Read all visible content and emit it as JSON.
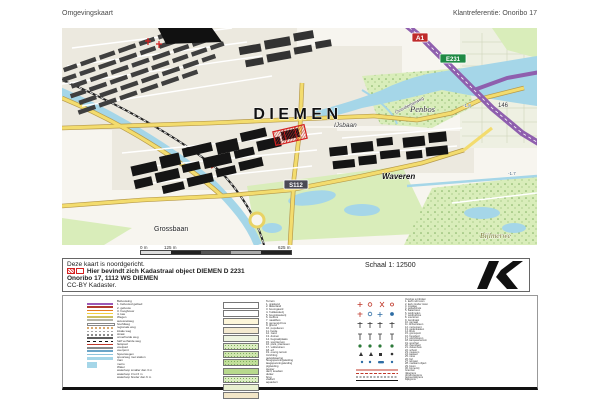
{
  "header": {
    "title": "Omgevingskaart",
    "client_reference": "Klantreferentie: Onoribo 17"
  },
  "map": {
    "labels": {
      "city": "DIEMEN",
      "ijsbaan": "IJsbaan",
      "penbos": "Penbos",
      "overdiemerweg": "Overdiemerweg",
      "waveren": "Waveren",
      "grossbaan": "Grossbaan",
      "bijlmerweide": "Bijlmerwe",
      "height_146": "146",
      "depth_18": "-1.8",
      "depth_17": "-1.7"
    },
    "shields": {
      "a1": "A1",
      "e231": "E231",
      "s112": "S112"
    },
    "colors": {
      "water": "#a5d6e8",
      "grass": "#d9edba",
      "field": "#eef0e2",
      "motorway": "#8f5fae",
      "main_road": "#f3dc6e",
      "building": "#151515",
      "residential_building": "#3f3f3f",
      "parcel_red": "#d42020",
      "urban_bg": "#f7f5ef"
    }
  },
  "scalebar": {
    "label_0": "0 m",
    "label_125": "125 m",
    "label_625": "625 m"
  },
  "infobox": {
    "line1": "Deze kaart is noordgericht.",
    "line2": "Hier bevindt zich Kadastraal object DIEMEN D 2231",
    "line3": "Onoribo 17, 1112 WS DIEMEN",
    "line4": "CC-BY Kadaster.",
    "scale": "Schaal 1: 12500"
  },
  "legend": {
    "colA_text": "Bebouwing\n1. bebouwd gebied\n2. gebouw\n3. hoogbouw\n4. kas\nWegen\nautosnelweg\nhoofdweg\nregionale weg\nlokale weg\nstraat\nonverharde weg\nhalf verharde weg\nfietspad\nvoetpad\nveerpont\nSpoorwegen\nspoorweg met station\ntram\nmetro\nWater\nwaterloop smaller dan 3 m\nwaterloop 3 tot 6 m\nwaterloop breder dan 6 m",
    "colC_text": "Terrein\n1. grasland\n2. akkerland\n3. boomgaard\n4. fruitkwekerij\n5. boomkwekerij\n6. loofbos\n7. naaldbos\n8. gemengd bos\n9. griend\n10. populieren\n11. heide\n12. zand\n13. duinen\n14. begraafplaats\n15. sportterrein\n16. park, plantsoen\n17. volkstuinen\n18. erf\n19. overig terrein\nInrichting\ngeluidswering\nhoogspanningsleiding\nlaagspanningsleiding\npijpleiding\nsteiger\ndam, koedam\nduiker\nbrug\nviaduct\naquaduct",
    "colE_text": "Overige symbolen\n1. kerk met toren\n2. kerk zonder toren\n3. moskee\n4. gebedshuis\n5. watertoren\n6. windmolen\n7. windturbine\n8. vuurtoren\n9. zendmast\n10. gemaal\n11. schoorsteen\n12. monument\n13. gedenkteken\n14. kruis\n15. grenspunt\n16. hunebed\n17. uitzichttoren\n18. kampeerterrein\n19. sporthal\n20. zwembad\n21. ziekenhuis\n22. school\n23. museum\n24. kasteel\n25. ruine\n26. fort\n27. telmast\n28. markant object\n29. boom\n30. bomenrij\nGrenzen\nrijksgrens\nprovinciegrens\ngemeentegrens\nwijkgrens"
  }
}
